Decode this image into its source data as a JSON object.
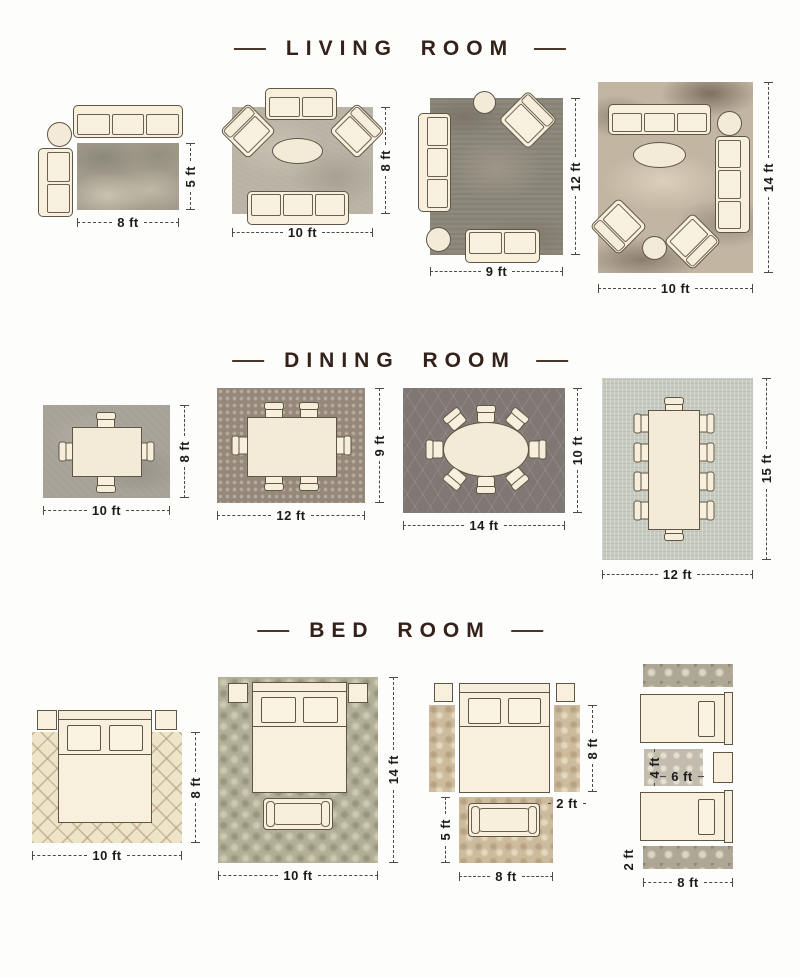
{
  "colors": {
    "background": "#fdfdfb",
    "title_text": "#33211a",
    "dimension_text": "#1d1c1b",
    "furniture_fill": "#f8f0dd",
    "furniture_outline": "#5f5746"
  },
  "sections": [
    {
      "title": "LIVING ROOM",
      "layouts": [
        {
          "name": "8x5-rug-furniture-off",
          "width_label": "8 ft",
          "height_label": "5 ft"
        },
        {
          "name": "10x8-rug-front-legs-on",
          "width_label": "10 ft",
          "height_label": "8 ft"
        },
        {
          "name": "9x12-rug",
          "width_label": "9 ft",
          "height_label": "12 ft"
        },
        {
          "name": "10x14-rug-all-legs-on",
          "width_label": "10 ft",
          "height_label": "14 ft"
        }
      ]
    },
    {
      "title": "DINING ROOM",
      "layouts": [
        {
          "name": "10x8-rug-4-seat-table",
          "width_label": "10 ft",
          "height_label": "8 ft"
        },
        {
          "name": "12x9-rug-6-seat-table",
          "width_label": "12 ft",
          "height_label": "9 ft"
        },
        {
          "name": "14x10-rug-oval-8-seat-table",
          "width_label": "14 ft",
          "height_label": "10 ft"
        },
        {
          "name": "12x15-rug-10-seat-table",
          "width_label": "12 ft",
          "height_label": "15 ft"
        }
      ]
    },
    {
      "title": "BED ROOM",
      "layouts": [
        {
          "name": "10x8-rug-partial-under-bed",
          "width_label": "10 ft",
          "height_label": "8 ft"
        },
        {
          "name": "10x14-rug-full-under-bed",
          "width_label": "10 ft",
          "height_label": "14 ft"
        },
        {
          "name": "side-runners-and-foot-rug",
          "foot_rug_width_label": "8 ft",
          "foot_rug_height_label": "5 ft",
          "runner_length_label": "8 ft",
          "runner_width_label": "2 ft"
        },
        {
          "name": "twin-beds-runners-between-rug",
          "runner_width_label": "8 ft",
          "runner_height_label": "2 ft",
          "between_rug_width_label": "6 ft",
          "between_rug_height_label": "4 ft"
        }
      ]
    }
  ]
}
